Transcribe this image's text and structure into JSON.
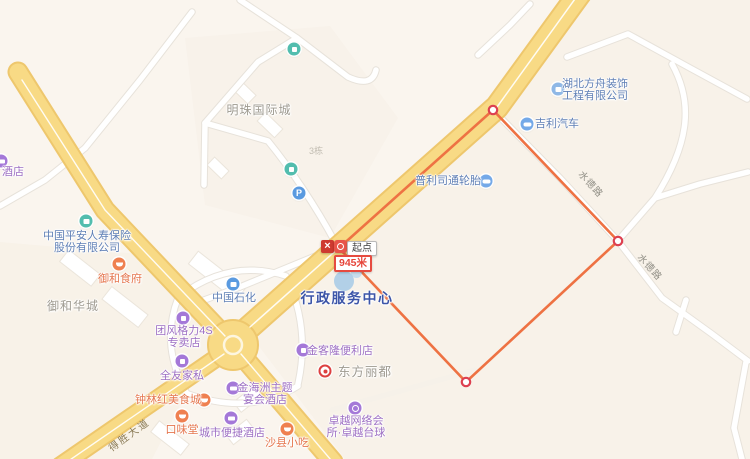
{
  "measurement": {
    "start_label": "起点",
    "distance_label": "945米",
    "points": [
      {
        "x": 339,
        "y": 248
      },
      {
        "x": 493,
        "y": 110
      },
      {
        "x": 618,
        "y": 241
      },
      {
        "x": 466,
        "y": 382
      }
    ],
    "closed": true
  },
  "map": {
    "labels": [
      {
        "id": "hotel-cut",
        "color": "purple",
        "icon": "hotel",
        "ix": 1,
        "iy": 161,
        "x": 13,
        "y": 172,
        "lines": [
          "酒店"
        ],
        "size": 11
      },
      {
        "id": "mingzhu-guojicheng",
        "color": "gray",
        "x": 259,
        "y": 110,
        "lines": [
          "明珠国际城"
        ],
        "size": 12
      },
      {
        "id": "building-3",
        "color": "faint",
        "x": 316,
        "y": 151,
        "lines": [
          "3栋"
        ],
        "size": 9
      },
      {
        "id": "hubei-fangzhou",
        "color": "blue",
        "icon": "company-blue",
        "ix": 558,
        "iy": 89,
        "x": 595,
        "y": 90,
        "lines": [
          "湖北方舟装饰",
          "工程有限公司"
        ],
        "size": 11
      },
      {
        "id": "geely-auto",
        "color": "blue",
        "icon": "car",
        "ix": 527,
        "iy": 124,
        "x": 557,
        "y": 124,
        "lines": [
          "吉利汽车"
        ],
        "size": 11
      },
      {
        "id": "bridgestone-tires",
        "color": "blue",
        "icon": "car",
        "ix": 486,
        "iy": 181,
        "x": 448,
        "y": 181,
        "lines": [
          "普利司通轮胎"
        ],
        "size": 11
      },
      {
        "id": "shuide-road-1",
        "color": "road",
        "x": 590,
        "y": 185,
        "lines": [
          "水德路"
        ],
        "size": 9.5,
        "rot": 48
      },
      {
        "id": "shuide-road-2",
        "color": "road",
        "x": 649,
        "y": 268,
        "lines": [
          "水德路"
        ],
        "size": 9.5,
        "rot": 48
      },
      {
        "id": "pingan-insurance",
        "color": "blue",
        "icon": "company-teal",
        "ix": 86,
        "iy": 221,
        "x": 87,
        "y": 242,
        "lines": [
          "中国平安人寿保险",
          "股份有限公司"
        ],
        "size": 11
      },
      {
        "id": "yuhe-shifu",
        "color": "orange",
        "icon": "restaurant",
        "ix": 119,
        "iy": 264,
        "x": 120,
        "y": 279,
        "lines": [
          "御和食府"
        ],
        "size": 11
      },
      {
        "id": "yuhe-huacheng",
        "color": "gray",
        "x": 73,
        "y": 306,
        "lines": [
          "御和华城"
        ],
        "size": 12
      },
      {
        "id": "sinopec",
        "color": "blue",
        "icon": "gas",
        "ix": 233,
        "iy": 284,
        "x": 234,
        "y": 298,
        "lines": [
          "中国石化"
        ],
        "size": 11
      },
      {
        "id": "admin-service-center",
        "color": "navy",
        "x": 347,
        "y": 298,
        "lines": [
          "行政服务中心"
        ],
        "size": 14,
        "bold": true,
        "ls": 1.5
      },
      {
        "id": "gree-4s-store",
        "color": "purple",
        "icon": "store",
        "ix": 183,
        "iy": 318,
        "x": 184,
        "y": 337,
        "lines": [
          "团风格力4S",
          "专卖店"
        ],
        "size": 11
      },
      {
        "id": "quanyou-jiasi",
        "color": "purple",
        "icon": "store",
        "ix": 182,
        "iy": 361,
        "x": 182,
        "y": 376,
        "lines": [
          "全友家私"
        ],
        "size": 11
      },
      {
        "id": "jinkelong-store",
        "color": "purple",
        "icon": "store",
        "ix": 303,
        "iy": 350,
        "x": 340,
        "y": 351,
        "lines": [
          "金客隆便利店"
        ],
        "size": 11
      },
      {
        "id": "dongfang-lidu",
        "color": "gray",
        "icon": "target",
        "ix": 325,
        "iy": 371,
        "x": 365,
        "y": 372,
        "lines": [
          "东方丽都"
        ],
        "size": 12.5
      },
      {
        "id": "jinhaizhou-hotel",
        "color": "purple",
        "icon": "hotel",
        "ix": 233,
        "iy": 388,
        "x": 265,
        "y": 394,
        "lines": [
          "金海洲主题",
          "宴会酒店"
        ],
        "size": 11
      },
      {
        "id": "zhonglinhong-food",
        "color": "orange",
        "icon": "restaurant",
        "ix": 204,
        "iy": 400,
        "x": 168,
        "y": 400,
        "lines": [
          "钟林红美食城"
        ],
        "size": 11
      },
      {
        "id": "kouweitang",
        "color": "orange",
        "icon": "restaurant",
        "ix": 182,
        "iy": 416,
        "x": 182,
        "y": 430,
        "lines": [
          "口味堂"
        ],
        "size": 11
      },
      {
        "id": "city-comfort-hotel",
        "color": "purple",
        "icon": "hotel",
        "ix": 231,
        "iy": 418,
        "x": 232,
        "y": 433,
        "lines": [
          "城市便捷酒店"
        ],
        "size": 11
      },
      {
        "id": "shaxian-xiaochi",
        "color": "orange",
        "icon": "restaurant",
        "ix": 287,
        "iy": 429,
        "x": 287,
        "y": 443,
        "lines": [
          "沙县小吃"
        ],
        "size": 11
      },
      {
        "id": "zhuoyue-billiards",
        "color": "purple",
        "icon": "billiard",
        "ix": 355,
        "iy": 408,
        "x": 356,
        "y": 427,
        "lines": [
          "卓越网络会",
          "所·卓越台球"
        ],
        "size": 11
      },
      {
        "id": "desheng-avenue",
        "color": "road-yellow",
        "x": 130,
        "y": 436,
        "lines": [
          "得胜大道"
        ],
        "size": 10,
        "rot": -36
      },
      {
        "id": "parking",
        "icon": "parking",
        "ix": 299,
        "iy": 193,
        "lines": []
      },
      {
        "id": "poi-teal-north",
        "icon": "teal-dot",
        "ix": 294,
        "iy": 49,
        "lines": []
      },
      {
        "id": "poi-teal-mid",
        "icon": "teal-dot",
        "ix": 291,
        "iy": 169,
        "lines": []
      }
    ]
  },
  "colors": {
    "background": "#faf5ee",
    "road_yellow_fill": "#f8da85",
    "road_yellow_casing": "#eec76d",
    "minor_road_fill": "#ffffff",
    "minor_road_casing": "#e7e2da",
    "measure_line_orange": "#ee7243",
    "measure_vertex_red": "#dd4050",
    "poi_purple": "#9d6fc3",
    "poi_orange": "#e5764e",
    "poi_blue": "#5f7fb5",
    "selected_poi_navy": "#3c55a8",
    "area_label_gray": "#9e9a90",
    "distance_box_red": "#e64b40"
  }
}
